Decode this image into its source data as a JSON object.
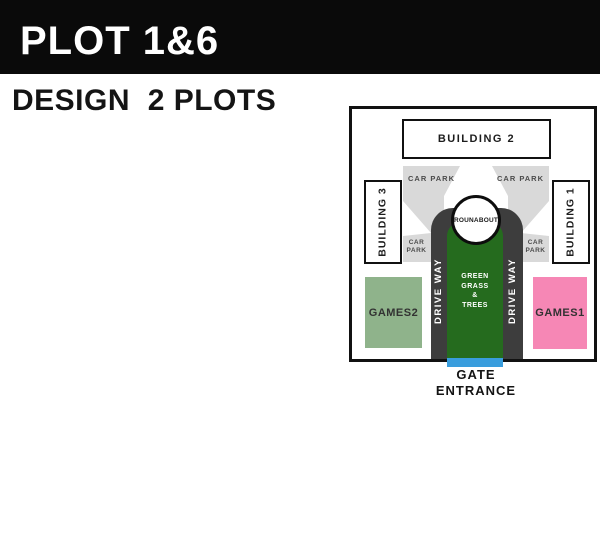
{
  "header": {
    "title": "PLOT 1&6",
    "subtitle": "DESIGN  2 PLOTS"
  },
  "map": {
    "building_top": "BUILDING 2",
    "building_left": "BUILDING 3",
    "building_right": "BUILDING 1",
    "car_park_top_left": "CAR PARK",
    "car_park_top_right": "CAR PARK",
    "car_park_mid_left": "CAR\nPARK",
    "car_park_mid_right": "CAR\nPARK",
    "roundabout": "ROUNABOUT",
    "driveway_left": "DRIVE WAY",
    "driveway_right": "DRIVE WAY",
    "green_area": "GREEN\nGRASS\n&\nTREES",
    "games_left": "GAMES2",
    "games_right": "GAMES1",
    "gate": "GATE\nENTRANCE"
  },
  "colors": {
    "banner_bg": "#0a0a0a",
    "car_park_gray": "#d9d9d9",
    "driveway_dark": "#3d3d3d",
    "green_area": "#256b1e",
    "games_left": "#8fb38b",
    "games_right": "#f687b5",
    "gate_blue": "#399ddd",
    "outline": "#111111"
  }
}
